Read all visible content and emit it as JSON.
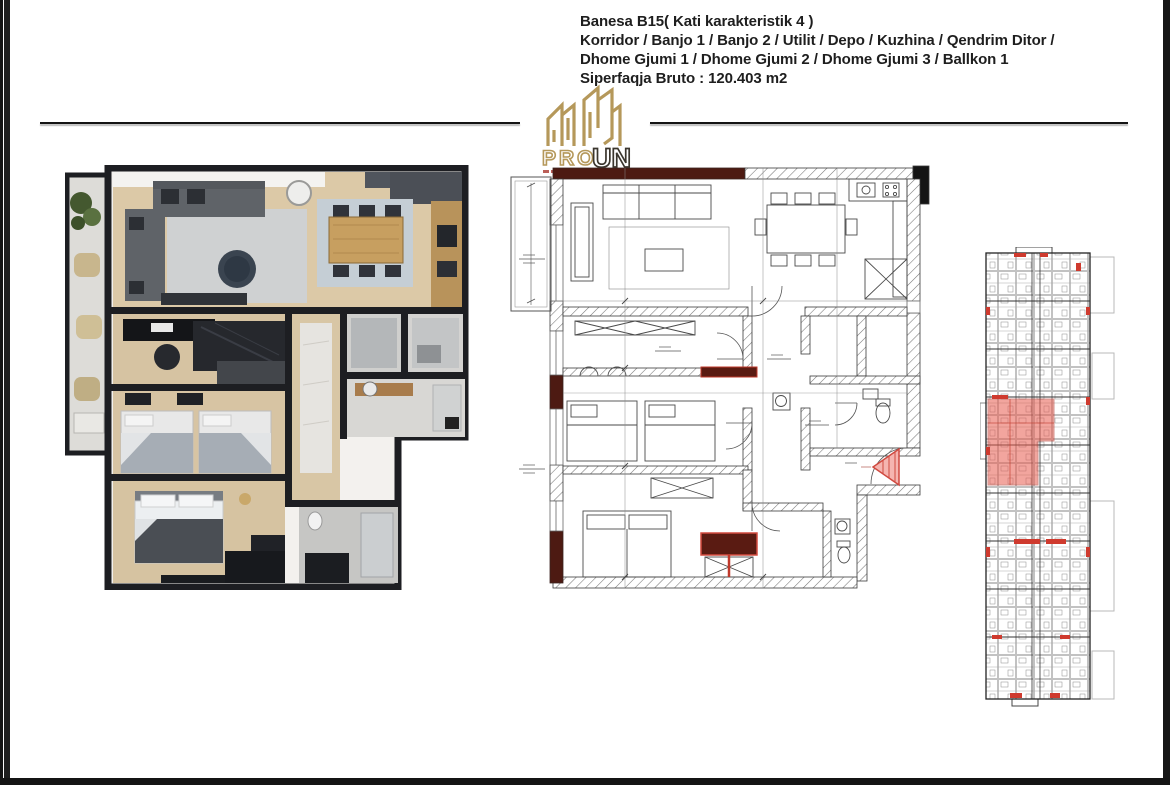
{
  "header": {
    "line1": "Banesa B15( Kati karakteristik 4 )",
    "line2": "Korridor / Banjo 1 / Banjo 2 / Utilit / Depo / Kuzhina / Qendrim Ditor /",
    "line3": "Dhome Gjumi 1 / Dhome Gjumi 2 / Dhome Gjumi 3 / Ballkon 1",
    "line4": "Siperfaqja Bruto : 120.403 m2"
  },
  "logo": {
    "text_primary": "PRO",
    "text_secondary": "UN",
    "gold": "#b5985a",
    "dark": "#3b362e",
    "accent_strip": "#b0443c"
  },
  "colors": {
    "page_background": "#ffffff",
    "frame_bars": "#161616",
    "divider_line": "#141414",
    "render_wall": "#1d1e22",
    "render_wood_floor": "#dcc9a7",
    "render_wood_cabinet": "#b8935b",
    "render_sofa_gray": "#5f6368",
    "render_rug_gray": "#cfd1d2",
    "drawing_line": "#3a3a3a",
    "drawing_maroon_wall": "#4d1a12",
    "drawing_red_accent": "#d04a40",
    "keyplan_highlight": "#e85d50"
  }
}
